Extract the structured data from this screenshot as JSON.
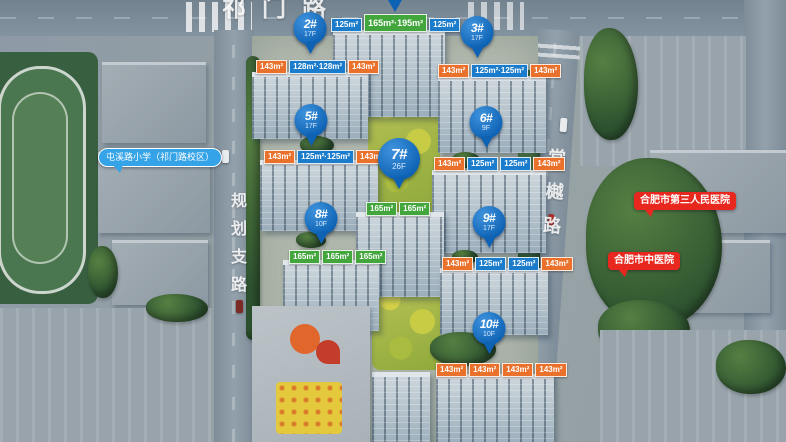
{
  "scene": {
    "title": "residential masterplan aerial rendering"
  },
  "roads": {
    "top": {
      "name": "祁门路"
    },
    "left": {
      "name": "规划支路"
    },
    "right": {
      "name": "棠樾路"
    }
  },
  "pois": {
    "school": {
      "label": "屯溪路小学（祁门路校区）",
      "color": "#35a3e8"
    },
    "hospital_third": {
      "label": "合肥市第三人民医院",
      "color": "#e8281e"
    },
    "hospital_tcm": {
      "label": "合肥市中医院",
      "color": "#e8281e"
    }
  },
  "pins": {
    "p2": {
      "label": "2#",
      "floors": "17F"
    },
    "p3": {
      "label": "3#",
      "floors": "17F"
    },
    "p5": {
      "label": "5#",
      "floors": "17F"
    },
    "p6": {
      "label": "6#",
      "floors": "9F"
    },
    "p7": {
      "label": "7#",
      "floors": "26F"
    },
    "p8": {
      "label": "8#",
      "floors": "10F"
    },
    "p9": {
      "label": "9#",
      "floors": "17F"
    },
    "p10": {
      "label": "10#",
      "floors": "10F"
    }
  },
  "buildings": {
    "b1": {
      "tags": [
        {
          "text": "125m²",
          "type": "blue"
        },
        {
          "text": "165m²·195m²",
          "type": "green"
        },
        {
          "text": "125m²",
          "type": "blue"
        }
      ]
    },
    "b2": {
      "tags": [
        {
          "text": "143m²",
          "type": "orange"
        },
        {
          "text": "128m²·128m²",
          "type": "blue"
        },
        {
          "text": "143m²",
          "type": "orange"
        }
      ]
    },
    "b3": {
      "tags": [
        {
          "text": "143m²",
          "type": "orange"
        },
        {
          "text": "125m²·125m²",
          "type": "blue"
        },
        {
          "text": "143m²",
          "type": "orange"
        }
      ]
    },
    "b5": {
      "tags": [
        {
          "text": "143m²",
          "type": "orange"
        },
        {
          "text": "125m²·125m²",
          "type": "blue"
        },
        {
          "text": "143m²",
          "type": "orange"
        }
      ]
    },
    "b6": {
      "tags": [
        {
          "text": "143m²",
          "type": "orange"
        },
        {
          "text": "125m²",
          "type": "blue"
        },
        {
          "text": "125m²",
          "type": "blue"
        },
        {
          "text": "143m²",
          "type": "orange"
        }
      ]
    },
    "b7": {
      "tags": [
        {
          "text": "165m²",
          "type": "green"
        },
        {
          "text": "165m²",
          "type": "green"
        }
      ]
    },
    "b8": {
      "tags": [
        {
          "text": "165m²",
          "type": "green"
        },
        {
          "text": "165m²",
          "type": "green"
        },
        {
          "text": "165m²",
          "type": "green"
        }
      ]
    },
    "b9": {
      "tags": [
        {
          "text": "143m²",
          "type": "orange"
        },
        {
          "text": "125m²",
          "type": "blue"
        },
        {
          "text": "125m²",
          "type": "blue"
        },
        {
          "text": "143m²",
          "type": "orange"
        }
      ]
    },
    "b10": {
      "tags": [
        {
          "text": "143m²",
          "type": "orange"
        },
        {
          "text": "143m²",
          "type": "orange"
        },
        {
          "text": "143m²",
          "type": "orange"
        },
        {
          "text": "143m²",
          "type": "orange"
        }
      ]
    }
  },
  "colors": {
    "pin_blue": "#0d62b4",
    "tag_blue": "#1b7ccb",
    "tag_orange": "#e9712b",
    "tag_green": "#43a63d",
    "poi_blue": "#35a3e8",
    "poi_red": "#e8281e"
  }
}
